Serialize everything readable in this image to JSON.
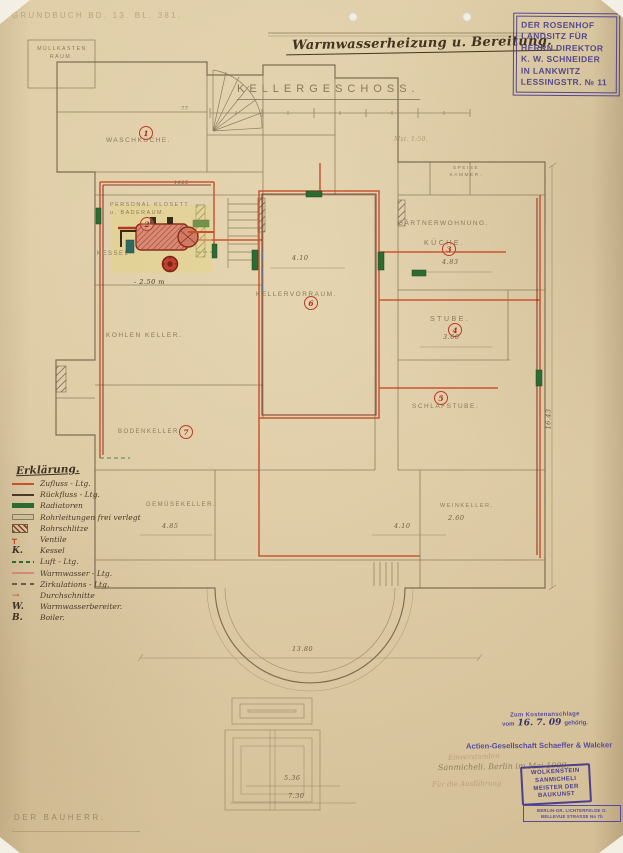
{
  "page": {
    "grundbuch_note": "GRUNDBUCH BD. 13. BL. 381.",
    "title": "Warmwasserheizung u. Bereitung.",
    "floor_heading": "KELLERGESCHOSS.",
    "scale_note": "Mst. 1:50.",
    "bauherr_label": "DER BAUHERR."
  },
  "owner_stamp": {
    "lines": [
      "DER ROSENHOF",
      "LANDSITZ FÜR",
      "HERRN DIREKTOR",
      "K. W. SCHNEIDER",
      "IN LANKWITZ",
      "LESSINGSTR. № 11"
    ]
  },
  "plan": {
    "rooms": {
      "muellkasten": "MÜLLKASTEN\nRAUM.",
      "waschkueche": "WASCHKÜCHE.",
      "personal_klosett": "PERSONAL KLOSETT\nu. BADERAUM.",
      "kessel": "KESSEL",
      "kohlenkeller": "KOHLEN KELLER.",
      "kellervorraum": "KELLERVORRAUM.",
      "gaertnerwohnung": "GÄRTNERWOHNUNG.",
      "kueche": "KÜCHE.",
      "stube": "STUBE.",
      "schlafstube": "SCHLAFSTUBE.",
      "bodenkeller": "BODENKELLER.",
      "gemuesekeller": "GEMÜSEKELLER.",
      "weinkeller": "WEINKELLER.",
      "speisekammer": "SPEISE\nKAMMER."
    },
    "room_numbers": [
      "1",
      "2",
      "3",
      "4",
      "5",
      "6",
      "7"
    ],
    "dimensions": {
      "hall_width": "4.10",
      "kueche_width": "4.83",
      "stube_width": "3.60",
      "gemuese_width": "4.85",
      "bottom_right_width": "4.10",
      "wein_width": "2.60",
      "overall_width": "13.80",
      "overall_height": "16.43",
      "steps_width_1": "5.36",
      "steps_width_2": "7.30",
      "boiler_level": "- 2.50 m",
      "pipe_mark": "1025",
      "tick_mark": "77"
    }
  },
  "legend": {
    "title": "Erklärung.",
    "entries": [
      {
        "sym": "red-line",
        "key": "",
        "text": "Zufluss - Ltg."
      },
      {
        "sym": "dark-line",
        "key": "",
        "text": "Rückfluss - Ltg."
      },
      {
        "sym": "green-bar",
        "key": "",
        "text": "Radiatoren"
      },
      {
        "sym": "gray-bar",
        "key": "",
        "text": "Rohrleitungen frei verlegt"
      },
      {
        "sym": "hatch-box",
        "key": "",
        "text": "Rohrschlitze"
      },
      {
        "sym": "red-valve",
        "key": "",
        "text": "Ventile"
      },
      {
        "sym": "letter",
        "key": "K.",
        "text": "Kessel"
      },
      {
        "sym": "green-dash",
        "key": "",
        "text": "Luft - Ltg."
      },
      {
        "sym": "pink-line",
        "key": "",
        "text": "Warmwasser - Ltg."
      },
      {
        "sym": "dash-line",
        "key": "",
        "text": "Zirkulations - Ltg."
      },
      {
        "sym": "red-arrow",
        "key": "",
        "text": "Durchschnitte"
      },
      {
        "sym": "letter",
        "key": "W.",
        "text": "Warmwasserbereiter."
      },
      {
        "sym": "letter",
        "key": "B.",
        "text": "Boiler."
      }
    ]
  },
  "approval": {
    "kosten_stamp": {
      "line1": "Zum Kostenanschlage",
      "vom": "vom",
      "date": "16. 7. 09",
      "line2": "gehörig."
    },
    "firm_stamp": "Actien-Gesellschaft Schaeffer & Walcker",
    "pencil_note_1": "Einverstanden",
    "pencil_note_2": "Sanmicheli. Berlin im Mai 1909.",
    "pencil_note_3": "Für die Ausführung",
    "master_stamp": {
      "lines": [
        "WOLKENSTEIN",
        "SANMICHELI",
        "MEISTER DER",
        "BAUKUNST"
      ]
    },
    "address_stamp": {
      "lines": [
        "BERLIN-GR. LICHTERFELDE O.",
        "BELLEVUE STRASSE No 7b"
      ]
    }
  },
  "colors": {
    "paper": "#dccaa3",
    "pencil": "#8a795a",
    "ink": "#42341f",
    "pipe_red": "#c8502c",
    "pipe_dark": "#7a241b",
    "radiator_green": "#2e6b33",
    "stamp_purple": "#4c3f8c",
    "wash_yellow": "#e6d678"
  }
}
